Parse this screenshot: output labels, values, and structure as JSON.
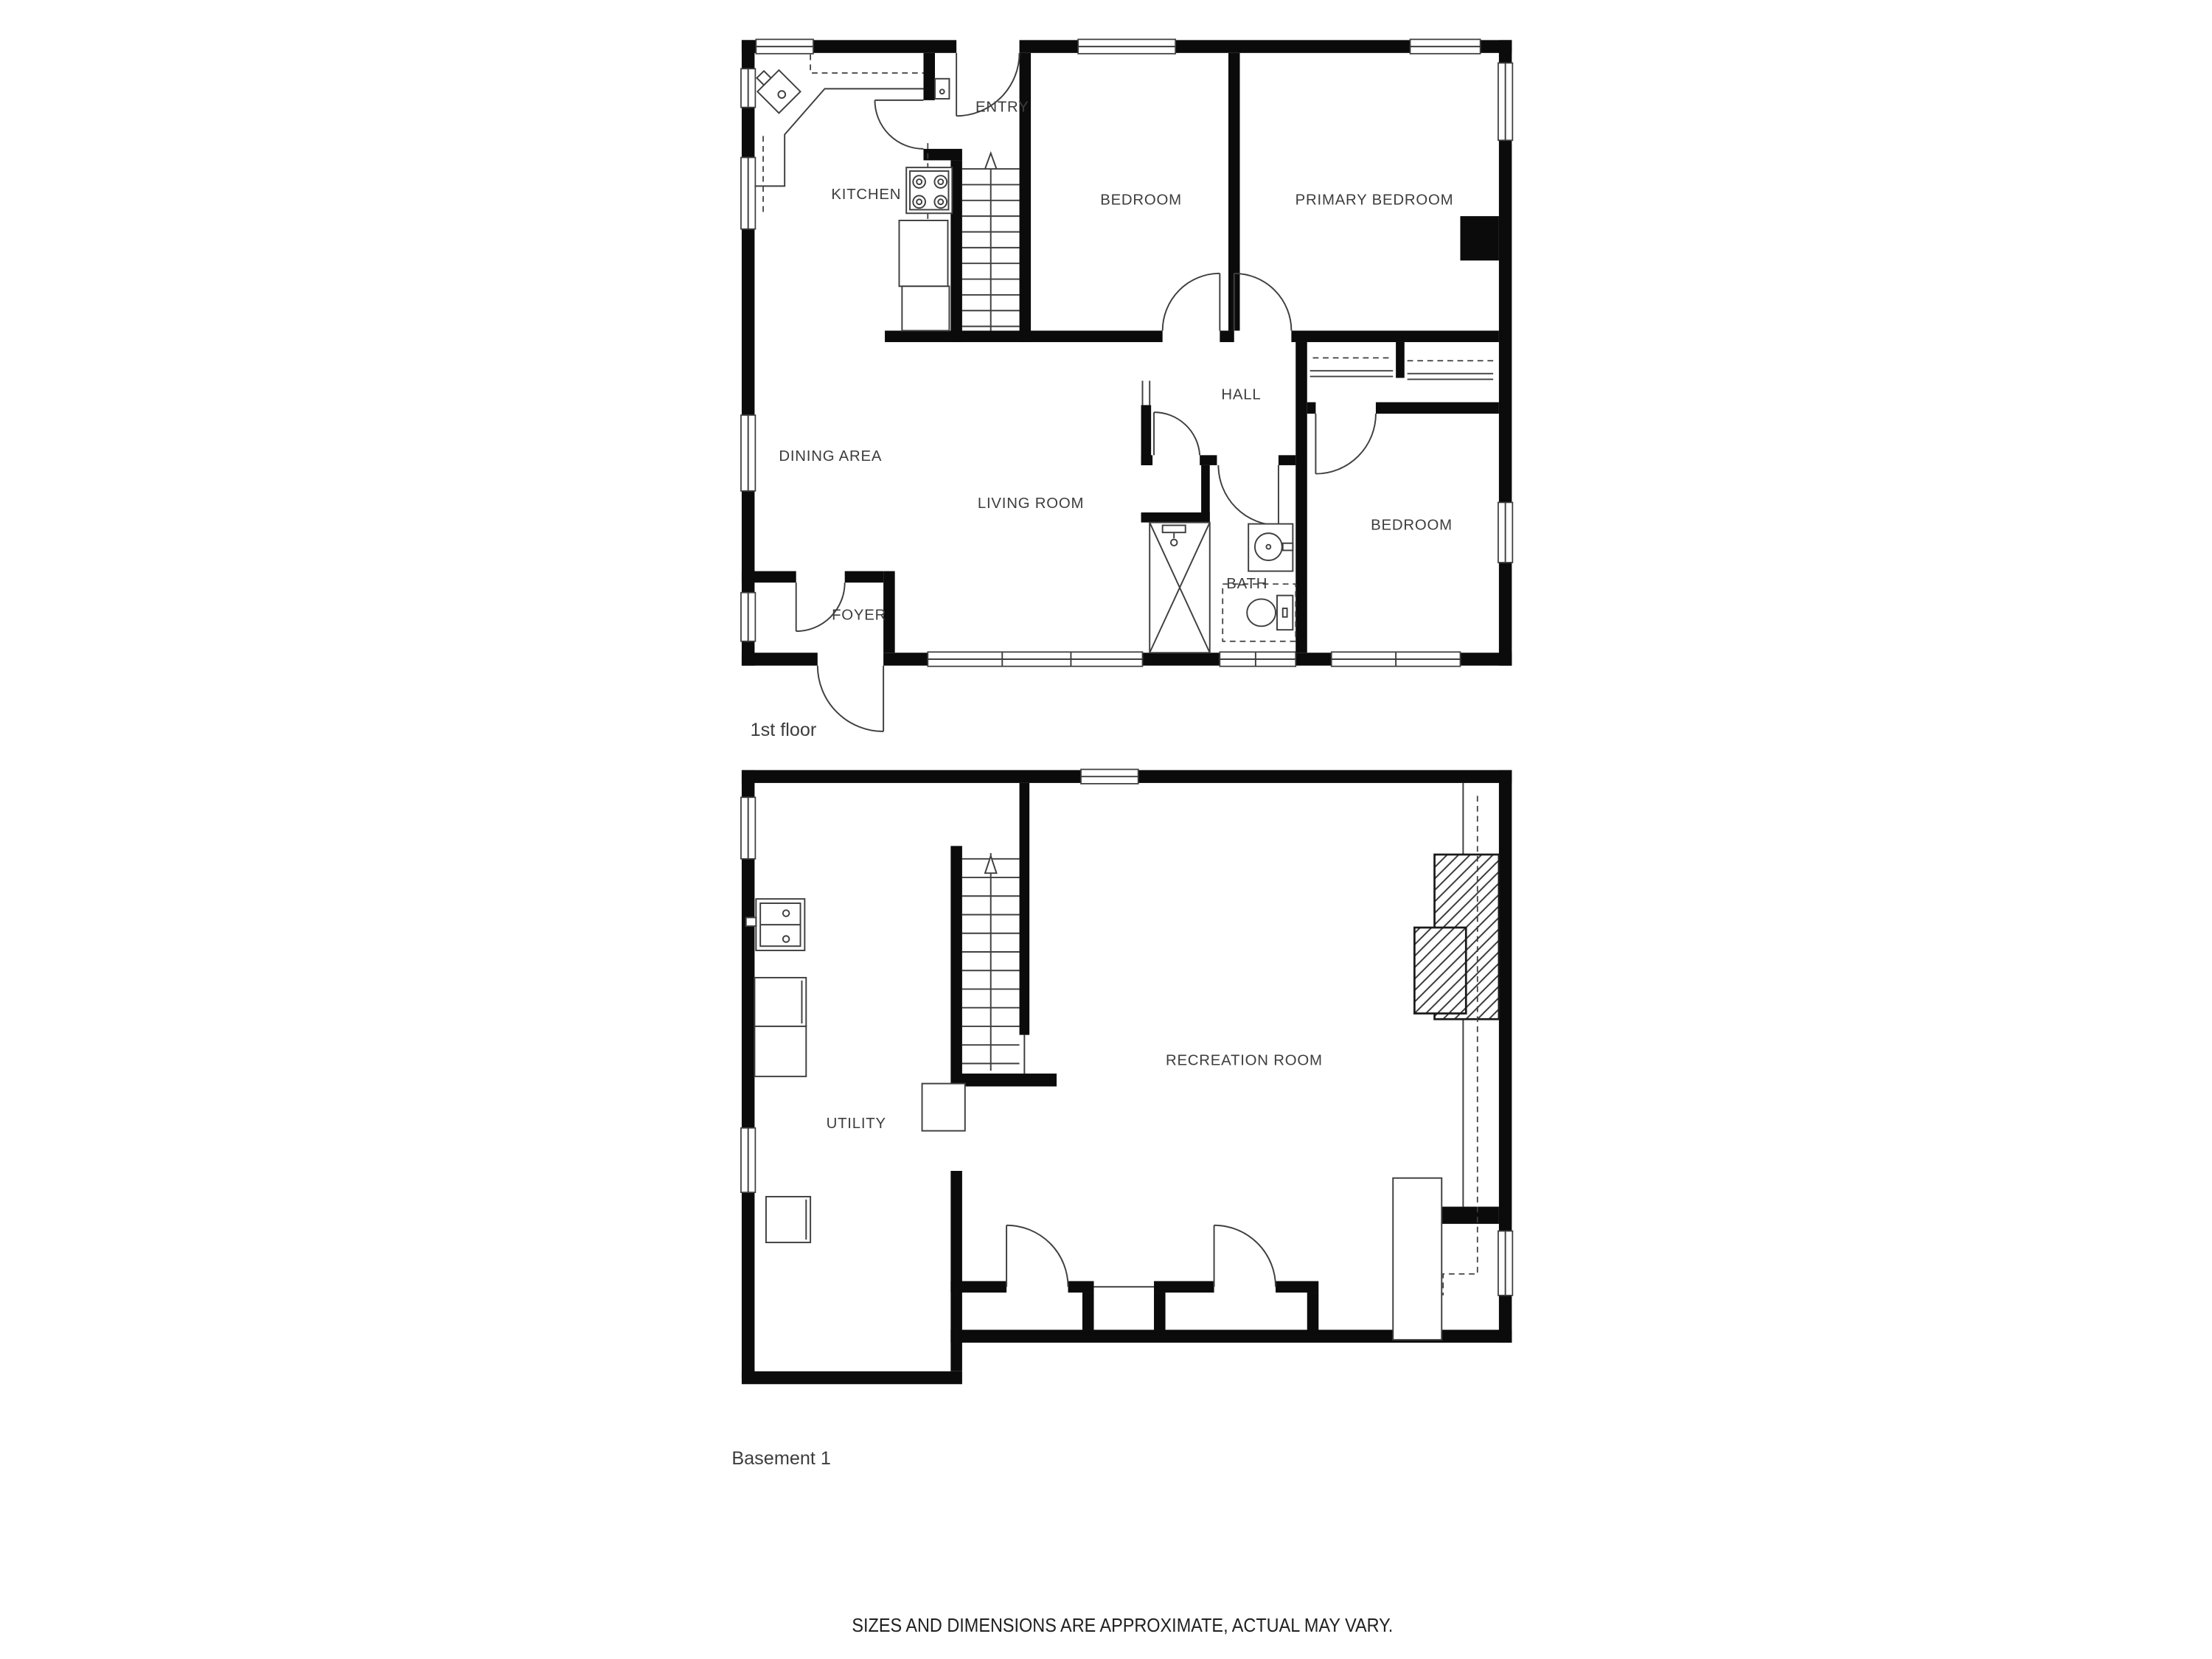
{
  "colors": {
    "background": "#ffffff",
    "wall": "#0b0b0b",
    "line": "#3f3f3f",
    "text": "#3d3d3d"
  },
  "floors": [
    {
      "id": "first-floor",
      "caption": "1st floor",
      "rooms": {
        "kitchen": {
          "label": "KITCHEN"
        },
        "entry": {
          "label": "ENTRY"
        },
        "bedroom_top": {
          "label": "BEDROOM"
        },
        "primary_bedroom": {
          "label": "PRIMARY BEDROOM"
        },
        "hall": {
          "label": "HALL"
        },
        "dining_area": {
          "label": "DINING AREA"
        },
        "living_room": {
          "label": "LIVING ROOM"
        },
        "bath": {
          "label": "BATH"
        },
        "bedroom_right": {
          "label": "BEDROOM"
        },
        "foyer": {
          "label": "FOYER"
        }
      }
    },
    {
      "id": "basement-1",
      "caption": "Basement 1",
      "rooms": {
        "utility": {
          "label": "UTILITY"
        },
        "recreation_room": {
          "label": "RECREATION ROOM"
        }
      }
    }
  ],
  "footer": {
    "disclaimer": "SIZES AND DIMENSIONS ARE APPROXIMATE, ACTUAL MAY VARY."
  }
}
